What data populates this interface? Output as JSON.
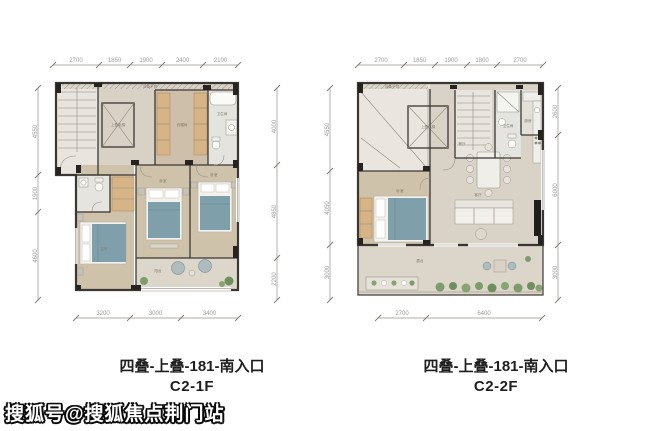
{
  "watermark": {
    "text": "搜狐号@搜狐焦点荆门站"
  },
  "plans": [
    {
      "caption_line1": "四叠-上叠-181-南入口",
      "caption_line2": "C2-1F",
      "dims_top": [
        "2700",
        "1850",
        "1900",
        "2400",
        "2100"
      ],
      "dims_bottom": [
        "3200",
        "3000",
        "3400"
      ],
      "dims_left": [
        "4550",
        "1900",
        "4600"
      ],
      "dims_right": [
        "4000",
        "4850",
        "2200"
      ],
      "rooms": {
        "equipment": "设备平台",
        "elevator": "上叠电梯",
        "closet": "衣帽间",
        "bath": "卫生间",
        "master": "主卧",
        "bedroom2": "卧室",
        "bedroom3": "卧室",
        "balcony": "阳台"
      }
    },
    {
      "caption_line1": "四叠-上叠-181-南入口",
      "caption_line2": "C2-2F",
      "dims_top": [
        "2700",
        "1850",
        "1900",
        "1800",
        "2700"
      ],
      "dims_bottom": [
        "2700",
        "6400"
      ],
      "dims_left": [
        "4550",
        "4050",
        "3000"
      ],
      "dims_right": [
        "2600",
        "6000",
        "3000"
      ],
      "rooms": {
        "equipment": "设备平台",
        "elevator": "上叠电梯",
        "bath": "卫生间",
        "kitchen": "厨房",
        "dining": "餐厅",
        "living": "客厅",
        "bedroom": "卧室",
        "terrace": "露台"
      }
    }
  ],
  "colors": {
    "wall": "#3b3733",
    "floor_hall": "#d8d1c5",
    "floor_wood": "#cfc2ab",
    "floor_service": "#e9e5de",
    "wardrobe": "#d7b488",
    "bed_blanket": "#7fa0ab",
    "plant": "#7d9c6c",
    "dim_text": "#9b9b9b",
    "caption_text": "#1e1e1e"
  }
}
